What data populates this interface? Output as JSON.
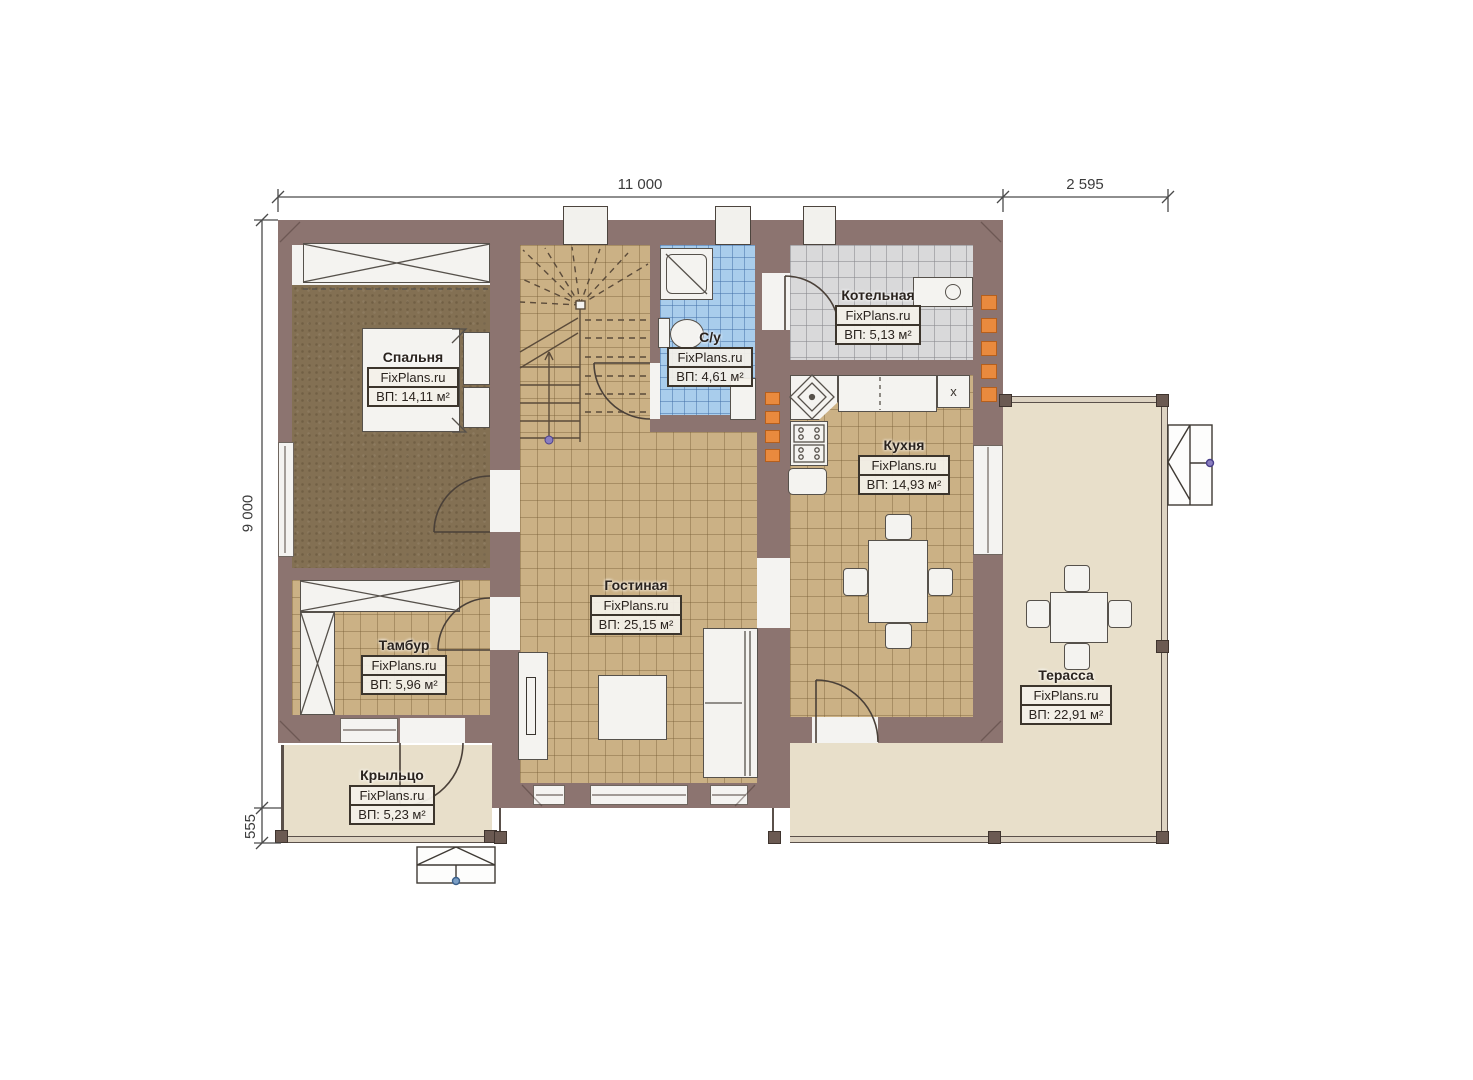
{
  "document": {
    "type": "floor-plan-drawing",
    "language": "ru"
  },
  "watermark": "FixPlans.ru",
  "dimensions": {
    "top_width": "11 000",
    "terrace_width": "2 595",
    "left_height": "9 000",
    "porch_depth": "555"
  },
  "rooms": [
    {
      "key": "bedroom",
      "name": "Спальня",
      "area": "ВП: 14,11 м²"
    },
    {
      "key": "bathroom",
      "name": "С/у",
      "area": "ВП: 4,61 м²"
    },
    {
      "key": "boiler-room",
      "name": "Котельная",
      "area": "ВП: 5,13 м²"
    },
    {
      "key": "kitchen",
      "name": "Кухня",
      "area": "ВП: 14,93 м²"
    },
    {
      "key": "living-room",
      "name": "Гостиная",
      "area": "ВП: 25,15 м²"
    },
    {
      "key": "vestibule",
      "name": "Тамбур",
      "area": "ВП: 5,96 м²"
    },
    {
      "key": "terrace",
      "name": "Терасса",
      "area": "ВП: 22,91 м²"
    },
    {
      "key": "porch",
      "name": "Крыльцо",
      "area": "ВП: 5,23 м²"
    }
  ],
  "marks": {
    "kitchen_cabinet": "x"
  },
  "colors": {
    "wall": "#8c7470",
    "tile_floor": "#cbb185",
    "wood_floor": "#837053",
    "bath_tile": "#a9cdec",
    "boiler_tile": "#d9d9da",
    "deck": "#e8dfca",
    "vent_accent": "#e98a3e",
    "label_border": "#3c352c",
    "label_bg": "#f3f0e9"
  }
}
